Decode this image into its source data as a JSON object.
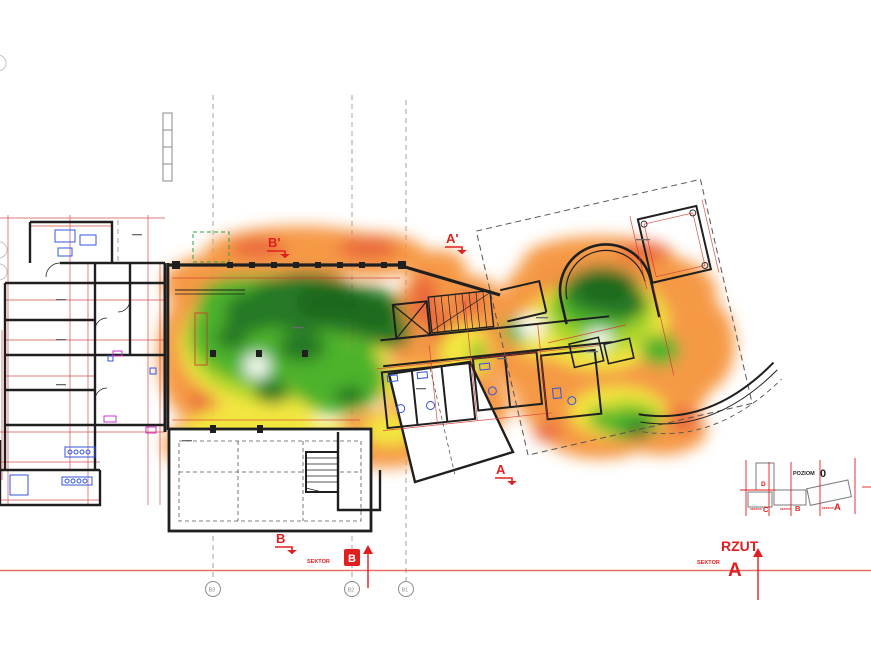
{
  "annotations": {
    "section_b_top": "B'",
    "section_a_top": "A'",
    "section_a_bottom": "A",
    "section_b_bottom": "B",
    "sector_b": {
      "label": "SEKTOR",
      "letter": "B"
    },
    "view": {
      "title": "RZUT",
      "sector_label": "SEKTOR",
      "sector_letter": "A"
    }
  },
  "grid": {
    "bubbles": [
      {
        "label": "B3"
      },
      {
        "label": "B2"
      },
      {
        "label": "B1"
      }
    ]
  },
  "keyplan": {
    "title": "POZIOM",
    "level": "0",
    "sector_micro": "SEKTOR",
    "sector_d": "D",
    "sector_c": "C",
    "sector_b": "B",
    "sector_a": "A"
  },
  "heat_scale": {
    "best": "#0a5c10",
    "strong": "#147012",
    "good": "#3fae1c",
    "fair": "#a6d31c",
    "weak": "#f2e531",
    "poor": "#f59238",
    "worst": "#e8542c"
  },
  "line_colors": {
    "walls": "#1f1f1f",
    "dimensions": "#d03030",
    "fixtures": "#3355dd",
    "accents": "#cc33cc",
    "annotation_red": "#e02020",
    "grid_gray": "#999999"
  }
}
